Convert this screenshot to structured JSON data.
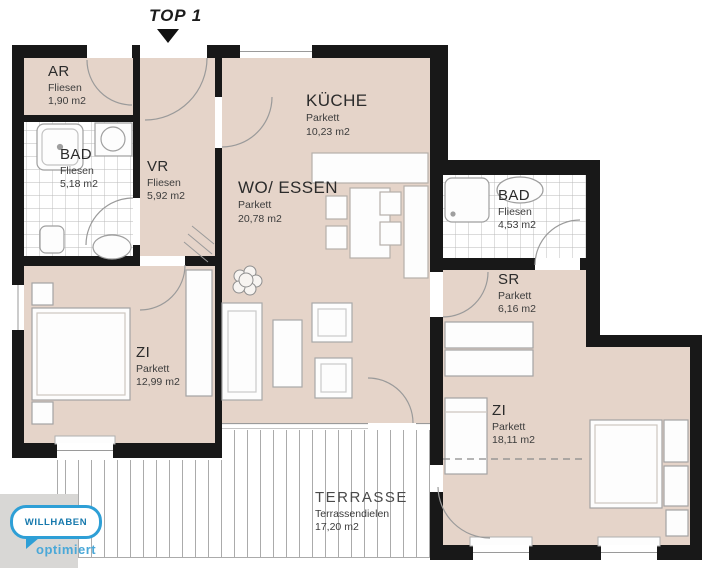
{
  "top_marker": {
    "label": "TOP 1"
  },
  "rooms": [
    {
      "id": "ar",
      "name": "AR",
      "floor": "Fliesen",
      "area": "1,90 m2"
    },
    {
      "id": "bad_left",
      "name": "BAD",
      "floor": "Fliesen",
      "area": "5,18 m2"
    },
    {
      "id": "vr",
      "name": "VR",
      "floor": "Fliesen",
      "area": "5,92 m2"
    },
    {
      "id": "kueche",
      "name": "KÜCHE",
      "floor": "Parkett",
      "area": "10,23 m2"
    },
    {
      "id": "wo_essen",
      "name": "WO/ ESSEN",
      "floor": "Parkett",
      "area": "20,78 m2"
    },
    {
      "id": "bad_right",
      "name": "BAD",
      "floor": "Fliesen",
      "area": "4,53 m2"
    },
    {
      "id": "sr",
      "name": "SR",
      "floor": "Parkett",
      "area": "6,16 m2"
    },
    {
      "id": "zi_left",
      "name": "ZI",
      "floor": "Parkett",
      "area": "12,99 m2"
    },
    {
      "id": "zi_right",
      "name": "ZI",
      "floor": "Parkett",
      "area": "18,11 m2"
    },
    {
      "id": "terrasse",
      "name": "TERRASSE",
      "floor": "Terrassendielen",
      "area": "17,20 m2"
    }
  ],
  "watermark": {
    "brand": "WILLHABEN",
    "tagline": "optimiert"
  },
  "colors": {
    "parquet_floor": "#e5d4c9",
    "wall": "#181818",
    "tile_line": "#b8b8b8",
    "deck_line": "#ababab",
    "logo_blue": "#2e9fd6",
    "logo_text_blue": "#1779ad"
  }
}
